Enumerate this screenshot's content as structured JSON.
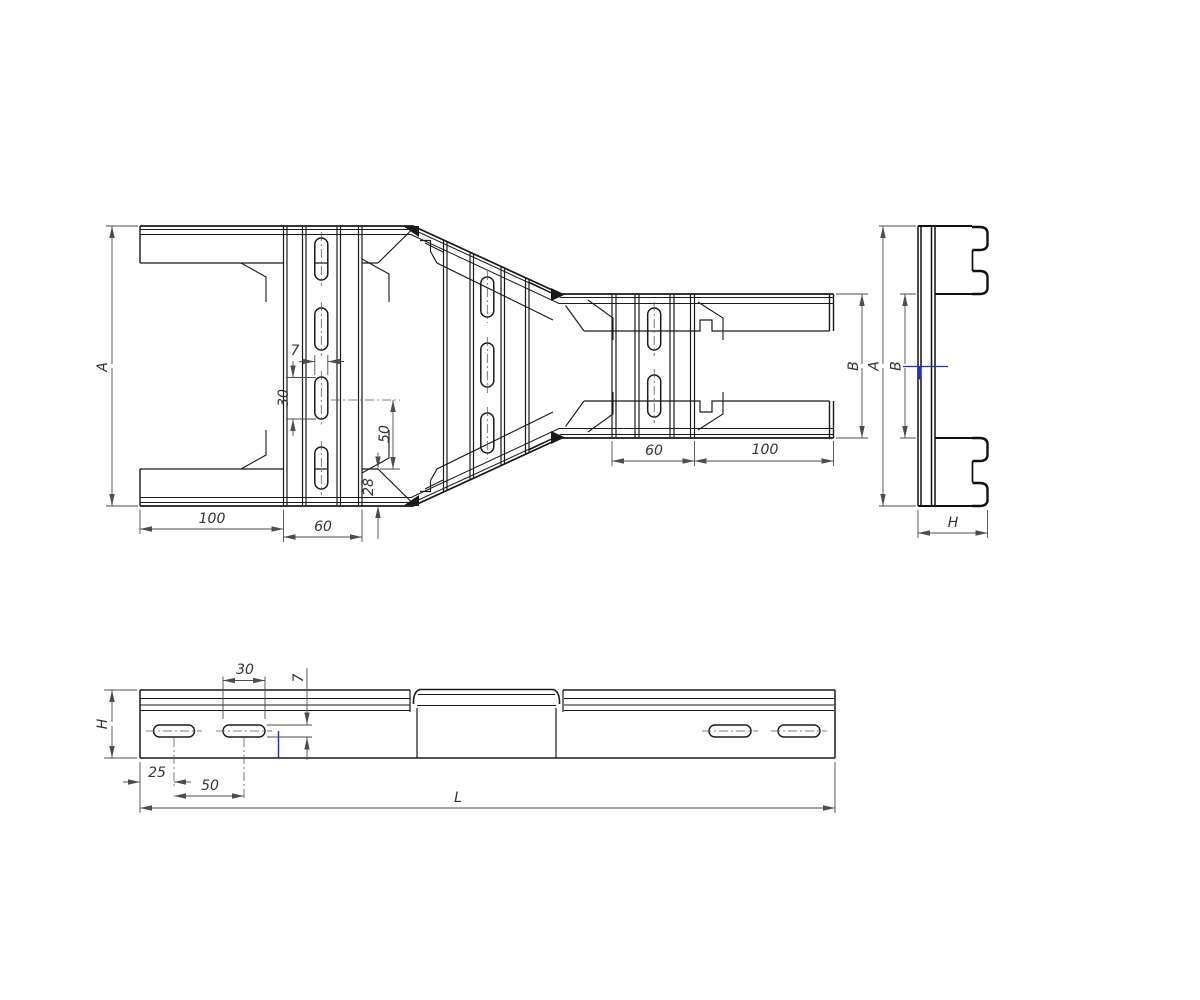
{
  "drawing_type": "cable-ladder-reducer-technical-drawing",
  "plan_view": {
    "label_a": "A",
    "label_100_left": "100",
    "label_60_left": "60",
    "label_7": "7",
    "label_30": "30",
    "label_50": "50",
    "label_28": "28",
    "label_60_right": "60",
    "label_100_right": "100",
    "label_b": "B"
  },
  "side_view": {
    "label_a": "A",
    "label_b": "B",
    "label_h": "H"
  },
  "elevation_view": {
    "label_h": "H",
    "label_30": "30",
    "label_7": "7",
    "label_25": "25",
    "label_50": "50",
    "label_l": "L"
  },
  "colors": {
    "line": "#1a1a1a",
    "dimension": "#4d4d4d",
    "accent_blue": "#2b2bc8",
    "background": "#ffffff"
  }
}
